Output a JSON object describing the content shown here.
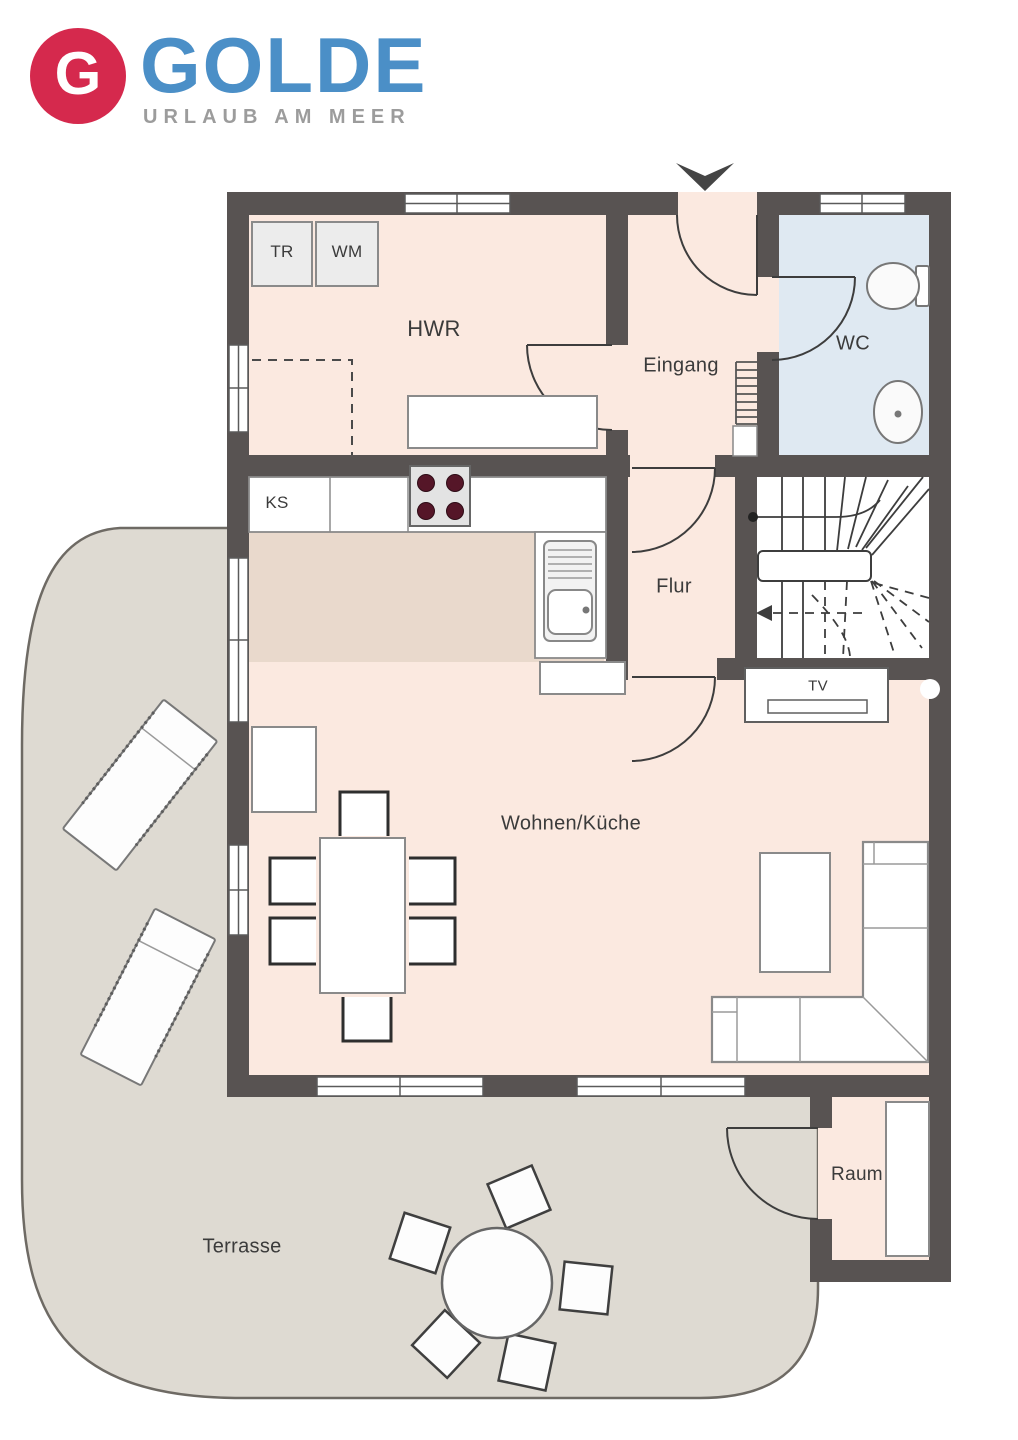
{
  "logo": {
    "letter": "G",
    "brand": "GOLDE",
    "tagline": "URLAUB AM MEER"
  },
  "floor_plan": {
    "rooms": {
      "hwr": "HWR",
      "eingang": "Eingang",
      "wc": "WC",
      "flur": "Flur",
      "wohnen_kueche": "Wohnen/Küche",
      "raum": "Raum",
      "terrasse": "Terrasse"
    },
    "appliances": {
      "tr": "TR",
      "wm": "WM",
      "ks": "KS",
      "tv": "TV"
    }
  },
  "colors": {
    "wall": "#585352",
    "room_fill": "#fbe9e0",
    "kitchen_fill": "#e9d9cc",
    "wc_fill": "#dfe9f2",
    "terrace_fill": "#dedad2",
    "terrace_edge": "#6e6a64",
    "logo_red": "#d5294d",
    "logo_blue": "#4b8fc7",
    "tagline_gray": "#9c9c9c",
    "label_ink": "#3b3b3b"
  }
}
